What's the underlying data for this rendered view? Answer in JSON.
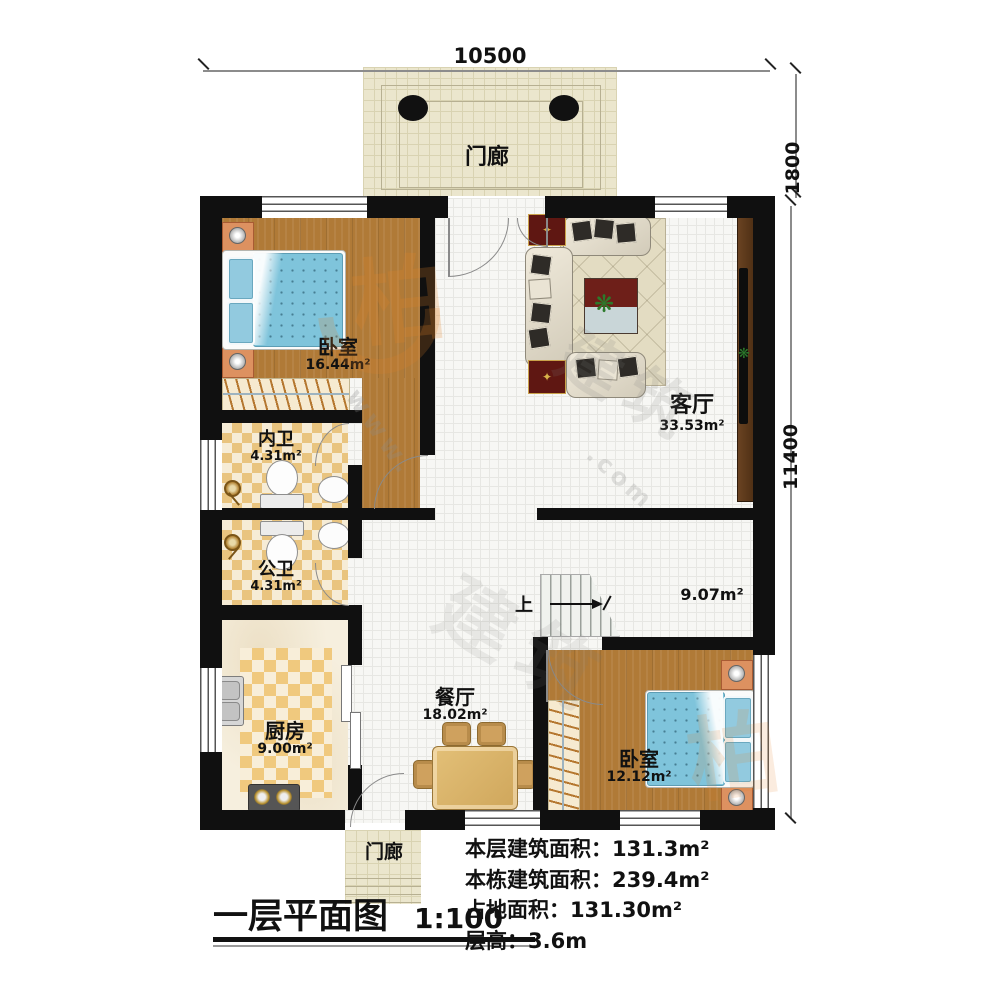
{
  "title": {
    "text": "一层平面图",
    "scale": "1:100"
  },
  "dimensions": {
    "width_top": "10500",
    "porch_depth": "1800",
    "height_right": "11400"
  },
  "rooms": {
    "porch_top": {
      "name": "门廊"
    },
    "bedroom_1": {
      "name": "卧室",
      "area": "16.44m²"
    },
    "living_room": {
      "name": "客厅",
      "area": "33.53m²"
    },
    "inner_bath": {
      "name": "内卫",
      "area": "4.31m²"
    },
    "public_bath": {
      "name": "公卫",
      "area": "4.31m²"
    },
    "kitchen": {
      "name": "厨房",
      "area": "9.00m²"
    },
    "dining_room": {
      "name": "餐厅",
      "area": "18.02m²"
    },
    "stair_hall": {
      "area": "9.07m²",
      "stairs_up": "上"
    },
    "bedroom_2": {
      "name": "卧室",
      "area": "12.12m²"
    },
    "porch_bottom": {
      "name": "门廊"
    }
  },
  "info_block": {
    "lines": [
      "本层建筑面积：131.3m²",
      "本栋建筑面积：239.4m²",
      "占地面积：131.30m²",
      "层高：3.6m"
    ]
  },
  "watermark": {
    "logo_char": "柏",
    "brand_chars": "建筑",
    "url_fragment_1": "www.",
    "url_fragment_2": ".com"
  },
  "colors": {
    "wall": "#101010",
    "wood_floor": "#b07a37",
    "bath_checker": "#e9c47f",
    "bed_blue": "#7fc4db",
    "watermark_orange": "#e28228"
  }
}
